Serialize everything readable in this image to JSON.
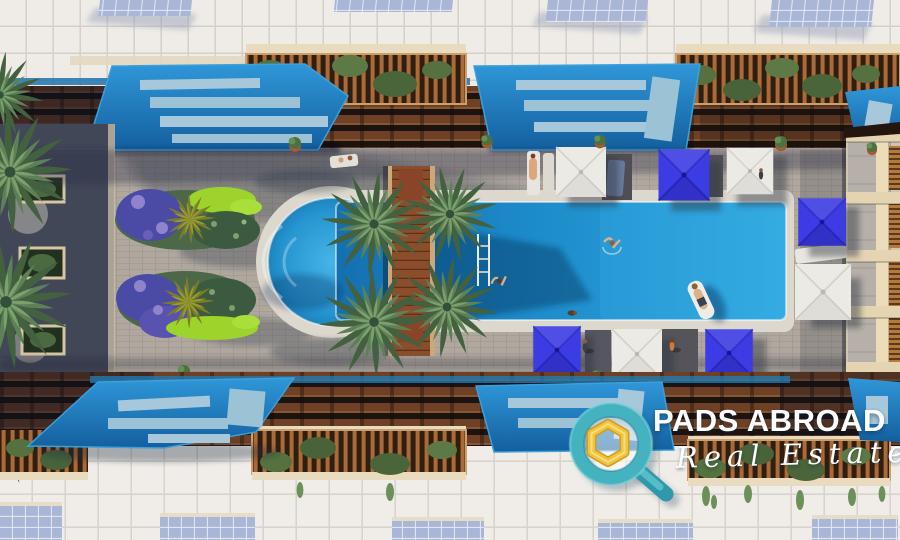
{
  "image": {
    "kind": "architectural-render",
    "description": "Aerial top-down 3D rendering of a resort courtyard: rectangular swimming pool with a rounded west end, wooden deck bridge with a cluster of four palm trees, purple and lime flower gardens, bright blue pergola canopies over wooden slatted pergolas, balcony railings with climbing plants, white tiled roofs with solar panels, and blue and white square sun umbrellas with loungers and tiny people."
  },
  "watermark": {
    "brand": "PADS ABROAD",
    "tagline": "Real Estate",
    "icon": "magnifier-house-icon",
    "colors": {
      "magnifier_teal": "#49b4c2",
      "house_gold": "#f2c33c",
      "text": "#ffffff"
    }
  },
  "palette": {
    "pool_water_deep": "#1470b0",
    "pool_water_bright": "#33aae2",
    "canopy_blue": "#1f74ae",
    "umbrella_blue": "#3c3ce4",
    "umbrella_white": "#eceae5",
    "roof_tile_white": "#efece7",
    "paver_gray": "#b0a89f",
    "wood_brown": "#6e4126",
    "palm_green": "#43603f",
    "lawn_lime": "#9cd42c",
    "flower_purple": "#4b4ba6",
    "facade_cream": "#ecdcba",
    "solar_panel_blue": "#aab6d6"
  },
  "objects": {
    "blue_umbrella_count": 4,
    "white_umbrella_count": 4,
    "palm_cluster_count": 4,
    "pool_swimmer_count": 3,
    "pool_float_count": 1
  }
}
